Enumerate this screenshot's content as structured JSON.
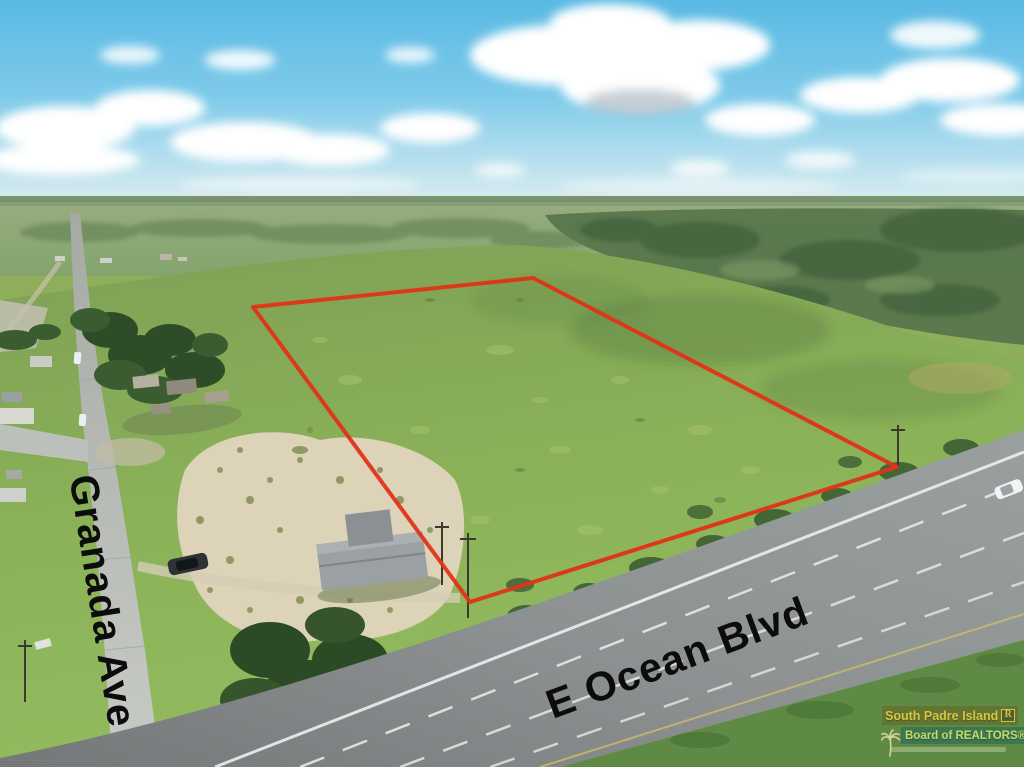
{
  "photo": {
    "kind": "aerial-drone-real-estate-photo",
    "street_label_vertical": "Granada Ave",
    "street_label_diagonal": "E Ocean Blvd"
  },
  "boundary": {
    "color": "#e03318",
    "stroke_width": "4",
    "points": "253,307 533,278 897,467 470,602"
  },
  "watermark": {
    "org_line1": "South Padre Island",
    "org_line2": "Board of REALTORS®",
    "logo_letter": "R",
    "gold_color": "#eed049",
    "green_color": "#dcea67"
  }
}
